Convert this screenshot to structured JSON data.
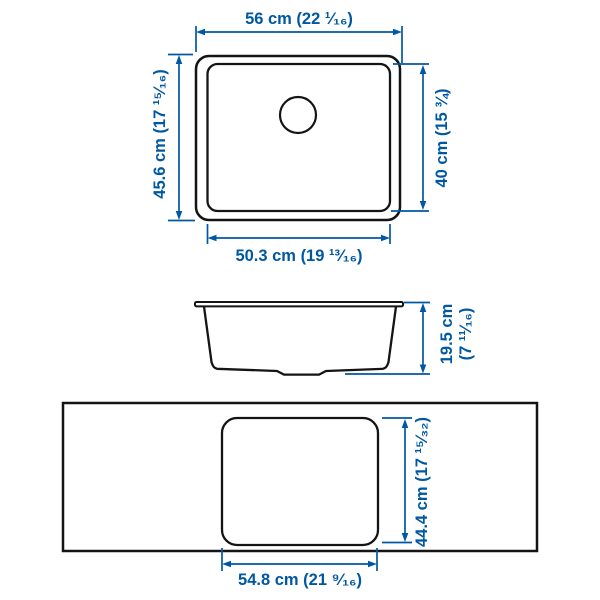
{
  "colors": {
    "accent": "#0058A3",
    "line": "#141414",
    "background": "#ffffff"
  },
  "views": {
    "top": {
      "labels": {
        "overall_width": "56 cm (22 ¹⁄₁₆)",
        "overall_depth": "45.6 cm (17 ¹⁵⁄₁₆)",
        "basin_depth": "40 cm (15 ¾)",
        "basin_width": "50.3 cm (19 ¹³⁄₁₆)"
      }
    },
    "side": {
      "labels": {
        "height_cm": "19.5 cm",
        "height_in": "(7 ¹¹⁄₁₆)"
      }
    },
    "cutout": {
      "labels": {
        "depth": "44.4 cm (17 ¹⁵⁄₃₂)",
        "width": "54.8 cm (21 ⁹⁄₁₆)"
      }
    }
  }
}
